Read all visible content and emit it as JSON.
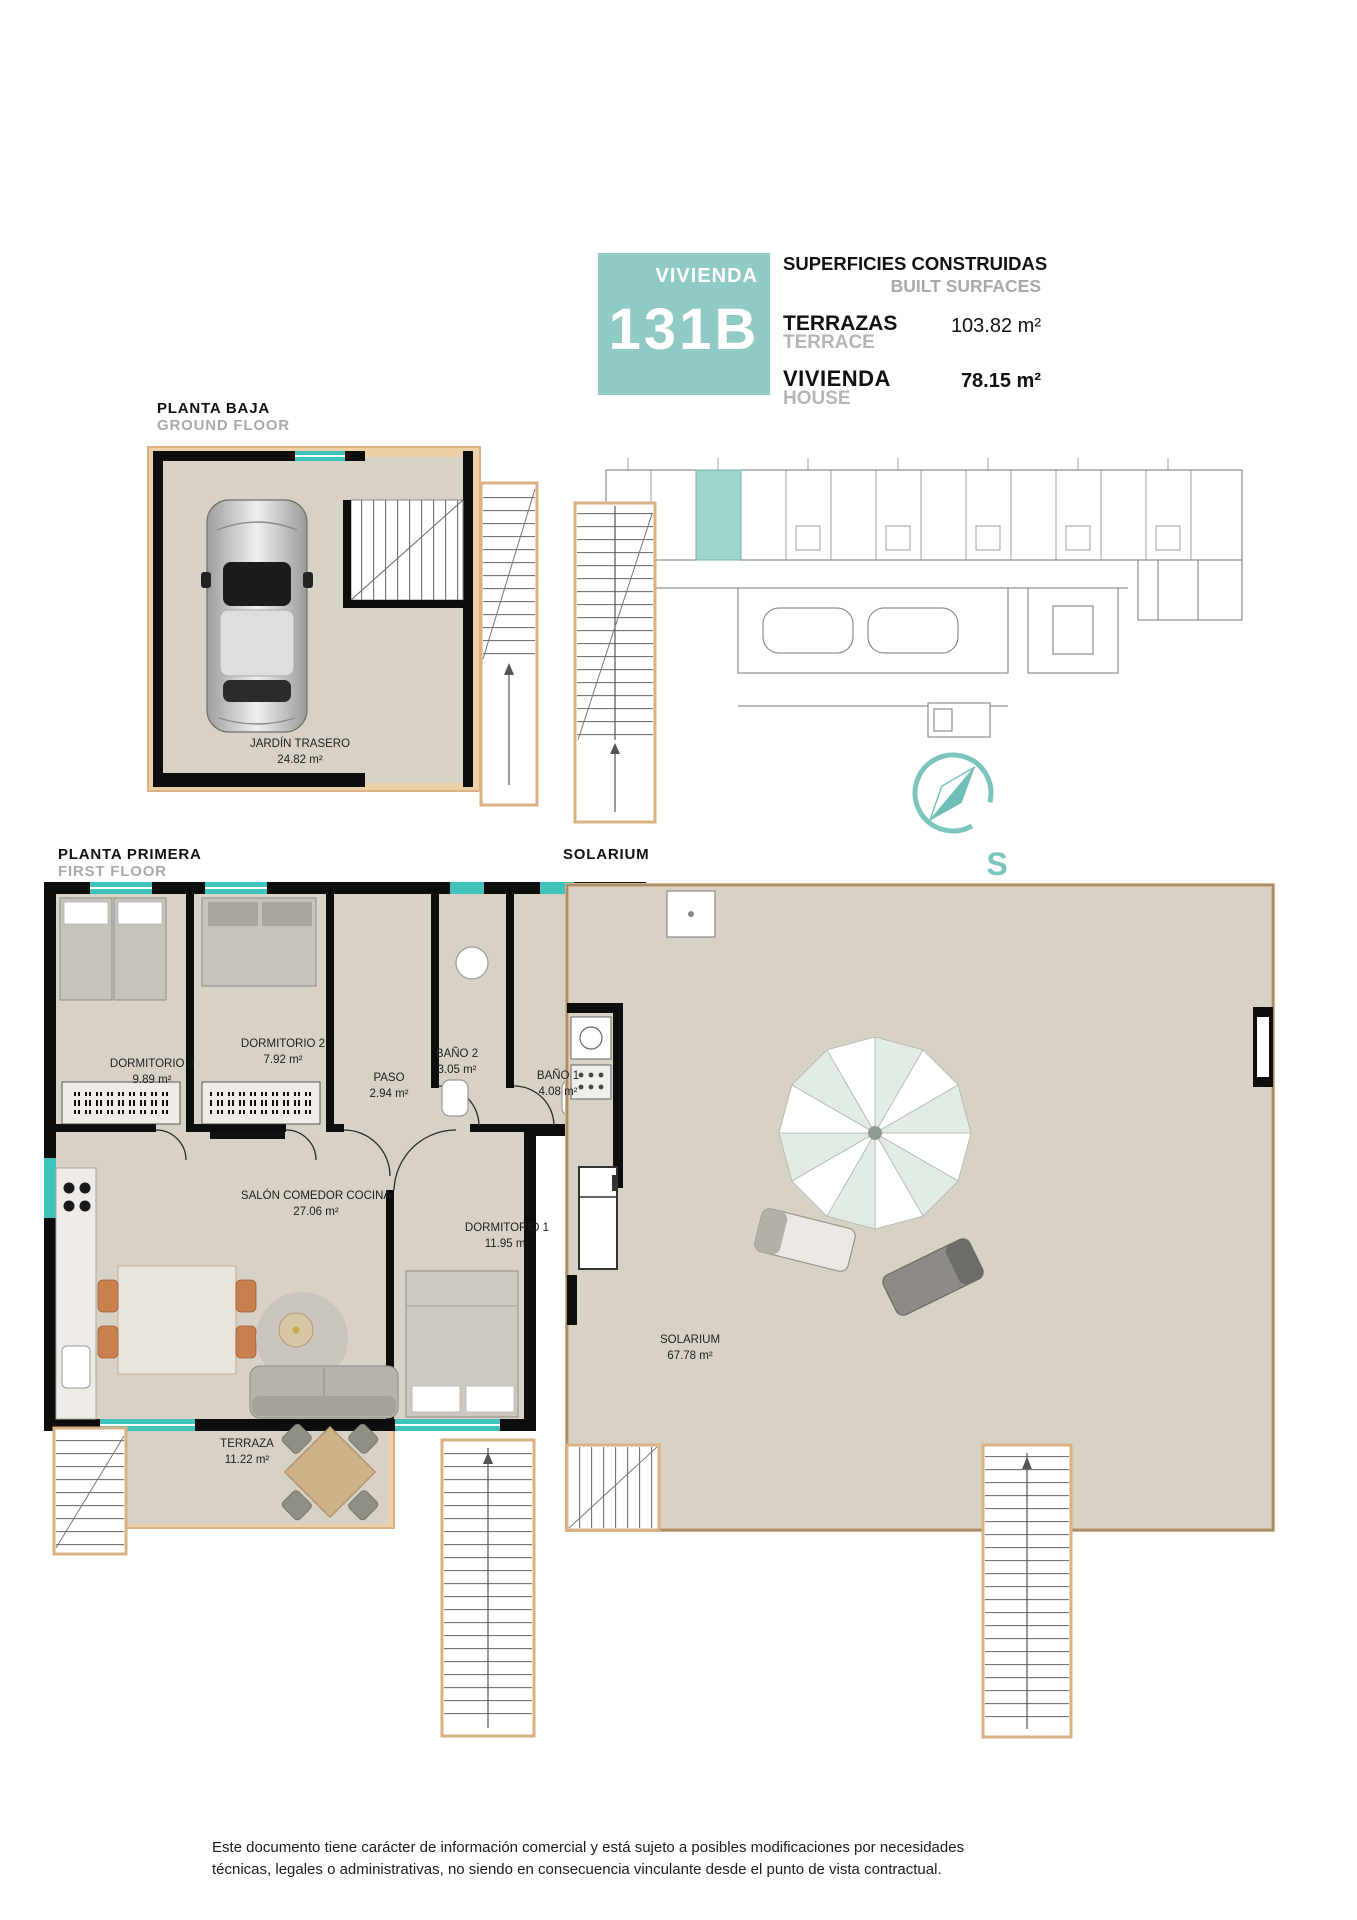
{
  "header": {
    "badge": {
      "label": "VIVIENDA",
      "unit": "131B"
    },
    "surfaces": {
      "title": "SUPERFICIES CONSTRUIDAS",
      "subtitle": "BUILT SURFACES",
      "rows": [
        {
          "label_es": "TERRAZAS",
          "label_en": "TERRACE",
          "value": "103.82 m²"
        },
        {
          "label_es": "VIVIENDA",
          "label_en": "HOUSE",
          "value": "78.15 m²"
        }
      ]
    }
  },
  "plans": {
    "ground_floor": {
      "title": "PLANTA BAJA",
      "subtitle": "GROUND FLOOR",
      "rooms": [
        {
          "name": "JARDÍN TRASERO",
          "area": "24.82 m²"
        }
      ]
    },
    "first_floor": {
      "title": "PLANTA PRIMERA",
      "subtitle": "FIRST FLOOR",
      "rooms": [
        {
          "name": "DORMITORIO 3",
          "area": "9.89 m²"
        },
        {
          "name": "DORMITORIO 2",
          "area": "7.92 m²"
        },
        {
          "name": "PASO",
          "area": "2.94 m²"
        },
        {
          "name": "BAÑO 2",
          "area": "3.05 m²"
        },
        {
          "name": "BAÑO 1",
          "area": "4.08 m²"
        },
        {
          "name": "SALÓN COMEDOR COCINA",
          "area": "27.06 m²"
        },
        {
          "name": "DORMITORIO 1",
          "area": "11.95 m²"
        },
        {
          "name": "TERRAZA",
          "area": "11.22 m²"
        }
      ]
    },
    "solarium": {
      "title": "SOLARIUM",
      "rooms": [
        {
          "name": "SOLARIUM",
          "area": "67.78 m²"
        }
      ]
    }
  },
  "compass": {
    "south_label": "S"
  },
  "footer": {
    "line1": "Este documento tiene carácter de información comercial y está sujeto a posibles modificaciones por necesidades",
    "line2": "técnicas, legales o administrativas, no siendo en consecuencia vinculante desde el punto de vista contractual."
  },
  "colors": {
    "accent_teal": "#8fcbc4",
    "window_teal": "#3fc4bc",
    "floor_beige": "#d8d1c6",
    "terrace_tan": "#eed0a6",
    "wall_black": "#0d0d0d",
    "muted_gray": "#a9a9a9"
  }
}
